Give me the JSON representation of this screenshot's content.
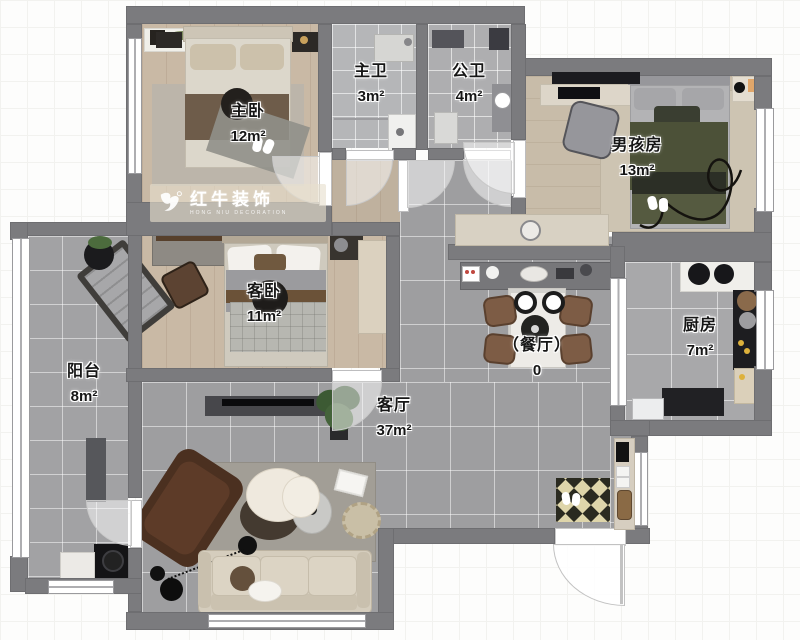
{
  "watermark": {
    "brand": "红牛装饰",
    "registered": "®",
    "subtitle": "HONG NIU DECORATION"
  },
  "rooms": {
    "master_bedroom": {
      "name": "主卧",
      "area": "12m²"
    },
    "master_bathroom": {
      "name": "主卫",
      "area": "3m²"
    },
    "public_bathroom": {
      "name": "公卫",
      "area": "4m²"
    },
    "boys_room": {
      "name": "男孩房",
      "area": "13m²"
    },
    "guest_bedroom": {
      "name": "客卧",
      "area": "11m²"
    },
    "kitchen": {
      "name": "厨房",
      "area": "7m²"
    },
    "dining_room": {
      "name": "（餐厅）",
      "area": "0"
    },
    "balcony": {
      "name": "阳台",
      "area": "8m²"
    },
    "living_room": {
      "name": "客厅",
      "area": "37m²"
    }
  },
  "colors": {
    "wall": "#7b7b7e",
    "bedroom_wood_floor": "#c9b9a5",
    "living_tile_floor": "#9e9ea0",
    "bathroom_tile": "#b5b6b8",
    "kitchen_tile": "#a8a8aa",
    "balcony_tile": "#a2a2a4",
    "boys_bed_green": "#4c5138",
    "sofa_beige": "#d5cdbd",
    "brand_watermark_bg": "#e7decd",
    "doormat_beige": "#ded5aa"
  }
}
